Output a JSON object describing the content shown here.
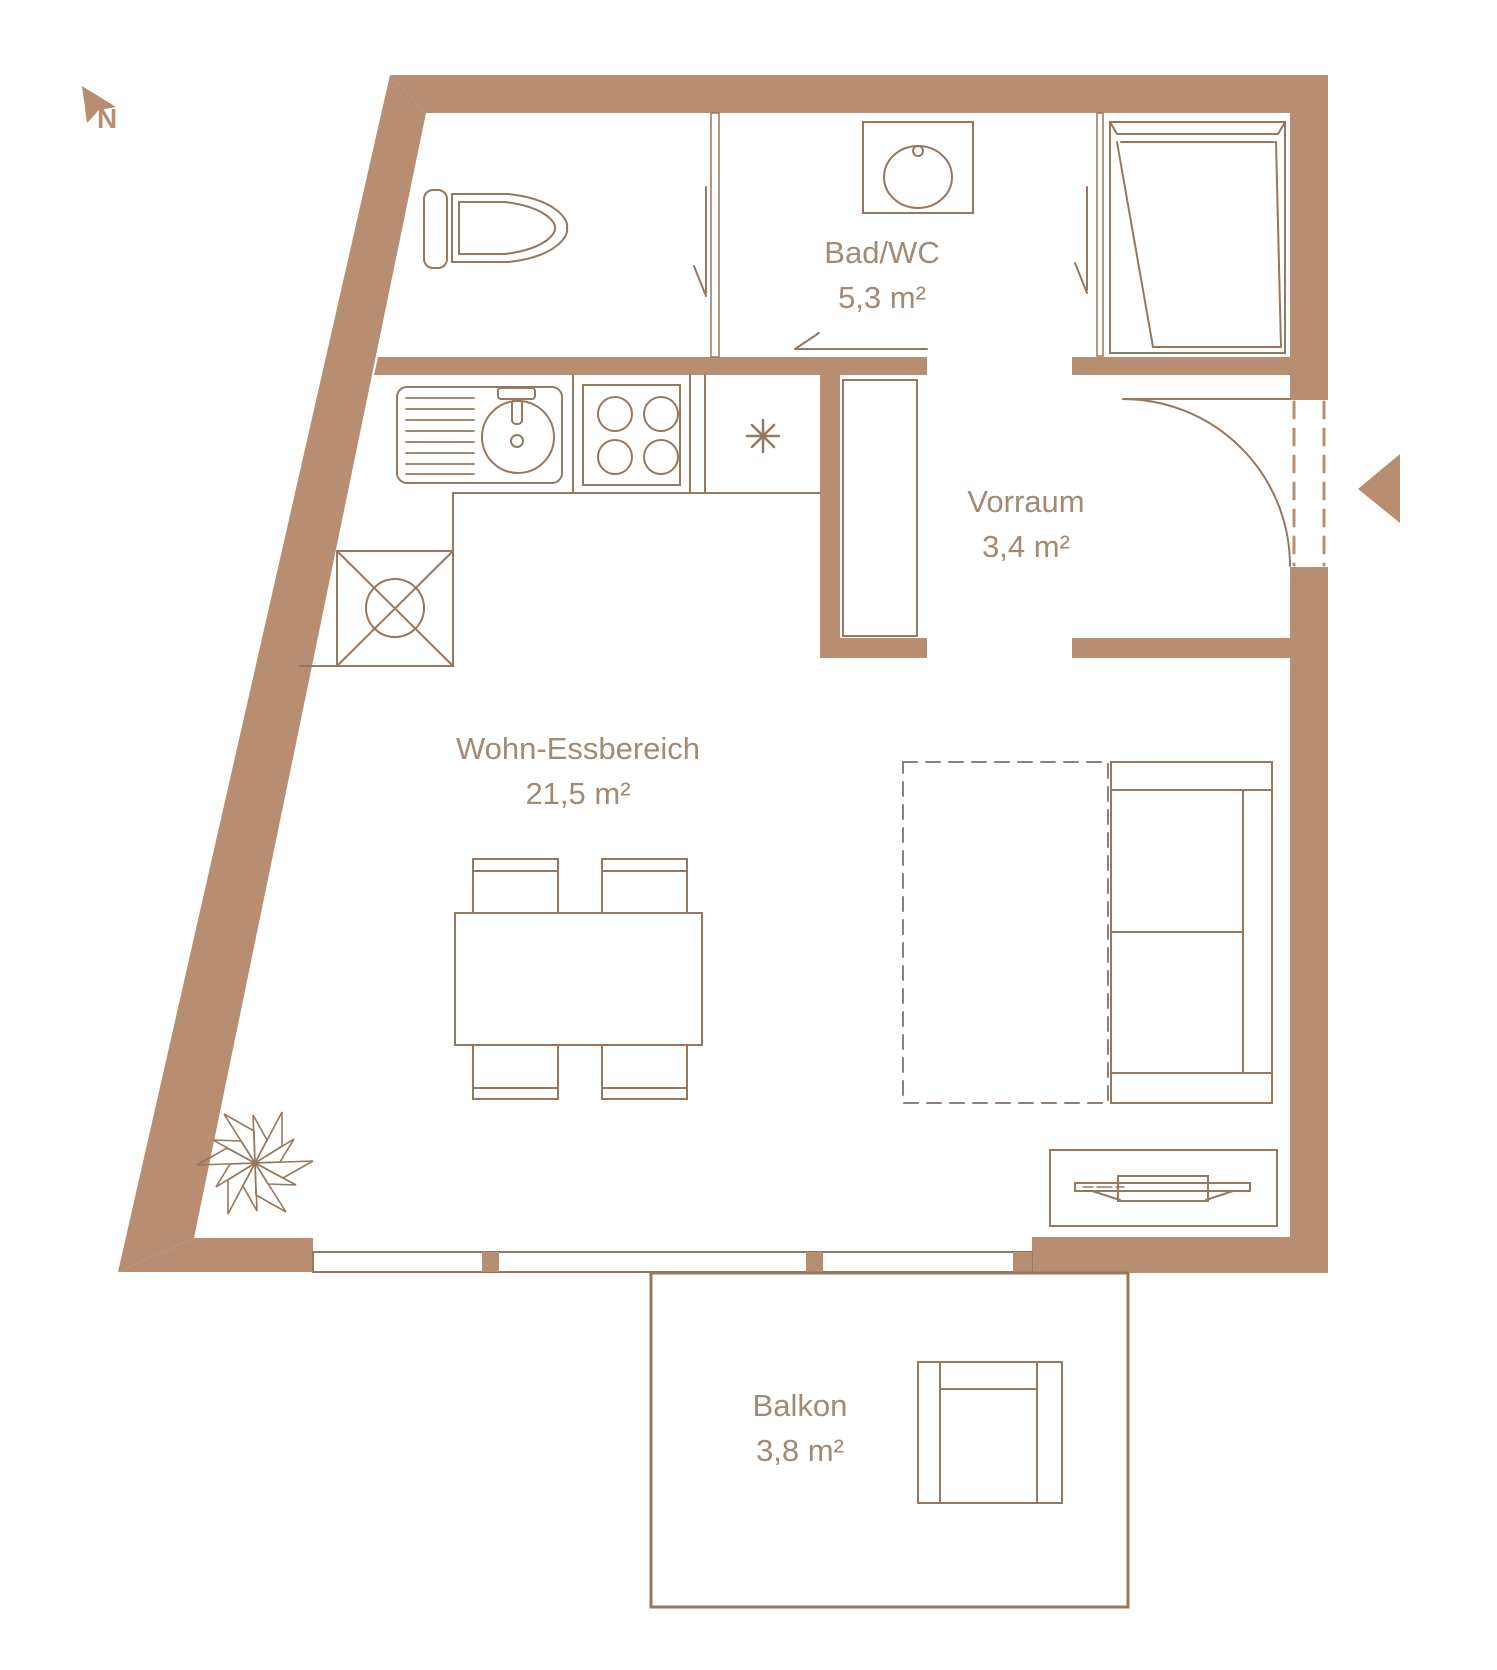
{
  "compass": {
    "label": "N"
  },
  "colors": {
    "wall": "#b78e72",
    "line": "#95785f",
    "text": "#a28a75",
    "bed_dash": "#8e8076",
    "background": "#ffffff"
  },
  "rooms": [
    {
      "name": "Bad/WC",
      "area": "5,3 m²"
    },
    {
      "name": "Vorraum",
      "area": "3,4 m²"
    },
    {
      "name": "Wohn-Essbereich",
      "area": "21,5 m²"
    },
    {
      "name": "Balkon",
      "area": "3,8 m²"
    }
  ],
  "fixtures": [
    "north-arrow",
    "toilet",
    "bathroom-sink",
    "shower",
    "kitchen-sink",
    "stove",
    "installation-shaft",
    "appliance-asterisk",
    "wardrobe",
    "bed-dashed",
    "sofa",
    "dining-table",
    "dining-chairs",
    "sideboard-tv",
    "plant",
    "balcony",
    "balcony-chair",
    "entrance-arrow",
    "entrance-door",
    "windows"
  ]
}
